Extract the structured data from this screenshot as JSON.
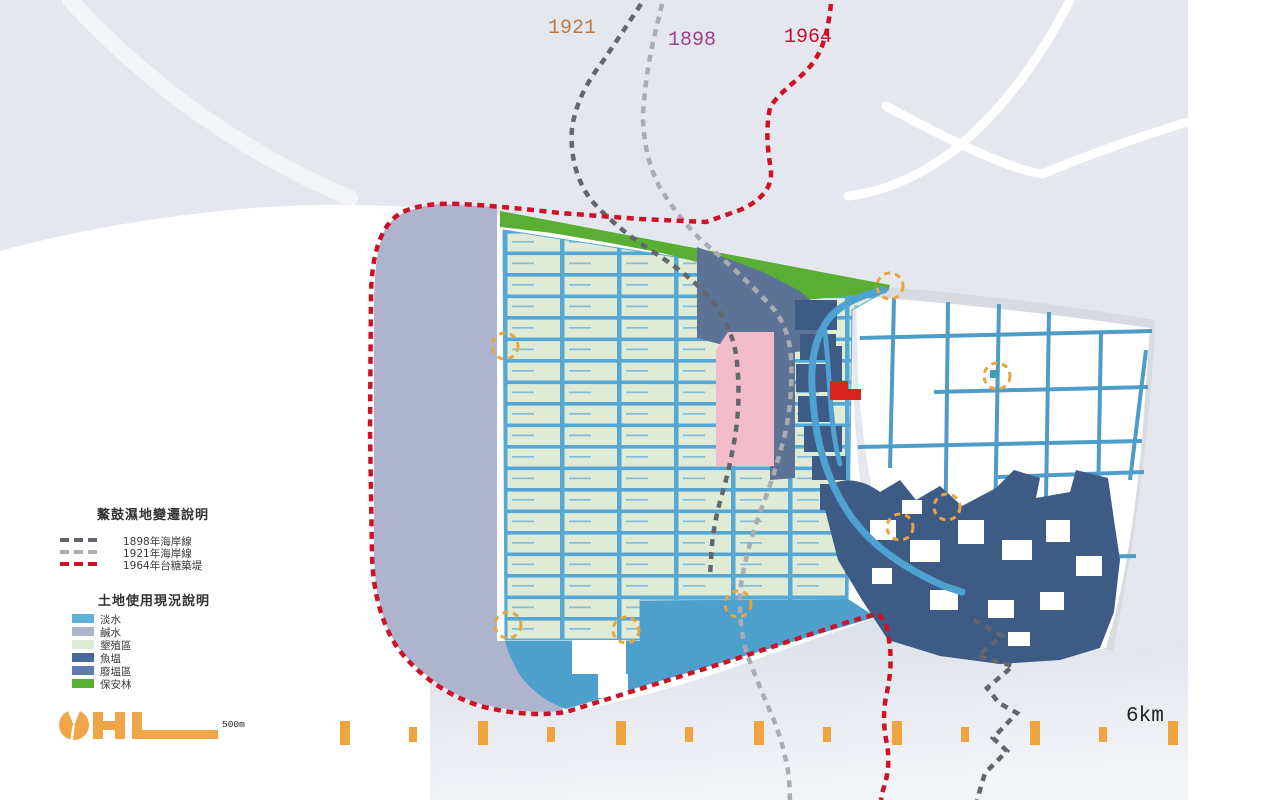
{
  "map_year_labels": [
    {
      "text": "1921",
      "color": "#BE7B43"
    },
    {
      "text": "1898",
      "color": "#9A3F92"
    },
    {
      "text": "1964",
      "color": "#C21331"
    }
  ],
  "legend_change": {
    "title": "鰲鼓濕地變遷說明",
    "items": [
      {
        "label": "1898年海岸線",
        "color": "#63676D",
        "style": "dashed"
      },
      {
        "label": "1921年海岸線",
        "color": "#A9ACB2",
        "style": "dashed"
      },
      {
        "label": "1964年台糖築堤",
        "color": "#CE1126",
        "style": "dashed"
      }
    ]
  },
  "legend_landuse": {
    "title": "土地使用現況說明",
    "items": [
      {
        "label": "淡水",
        "color": "#5FB0D8"
      },
      {
        "label": "鹹水",
        "color": "#AEB3CE"
      },
      {
        "label": "墾殖區",
        "color": "#DFEBD4"
      },
      {
        "label": "魚塭",
        "color": "#47699B"
      },
      {
        "label": "廢塭區",
        "color": "#5F7CAE"
      },
      {
        "label": "保安林",
        "color": "#5AAE34"
      }
    ]
  },
  "scale_bar": {
    "label": "500m",
    "logo_color": "#F0A648"
  },
  "ruler": {
    "label": "6km",
    "tick_color": "#F0A43F"
  },
  "annotations": {
    "highlight_circle_color": "#E9A53D"
  },
  "map_colors": {
    "fresh_water": "#4EA0CC",
    "salt_water": "#AEB3CE",
    "reclamation_area": "#DFEBD4",
    "fish_pond_blocks": "#3D5B84",
    "abandoned_pond_area": "#5C7396",
    "protection_forest": "#5AAE34",
    "pink_area": "#F3BCCB",
    "red_landmark": "#D8231E",
    "pond_grid_line": "#55A8D5",
    "road_line": "#4E9CC8",
    "coastline_1898": "#63676D",
    "coastline_1921": "#A9ACB2",
    "embankment_1964": "#CE1126"
  }
}
